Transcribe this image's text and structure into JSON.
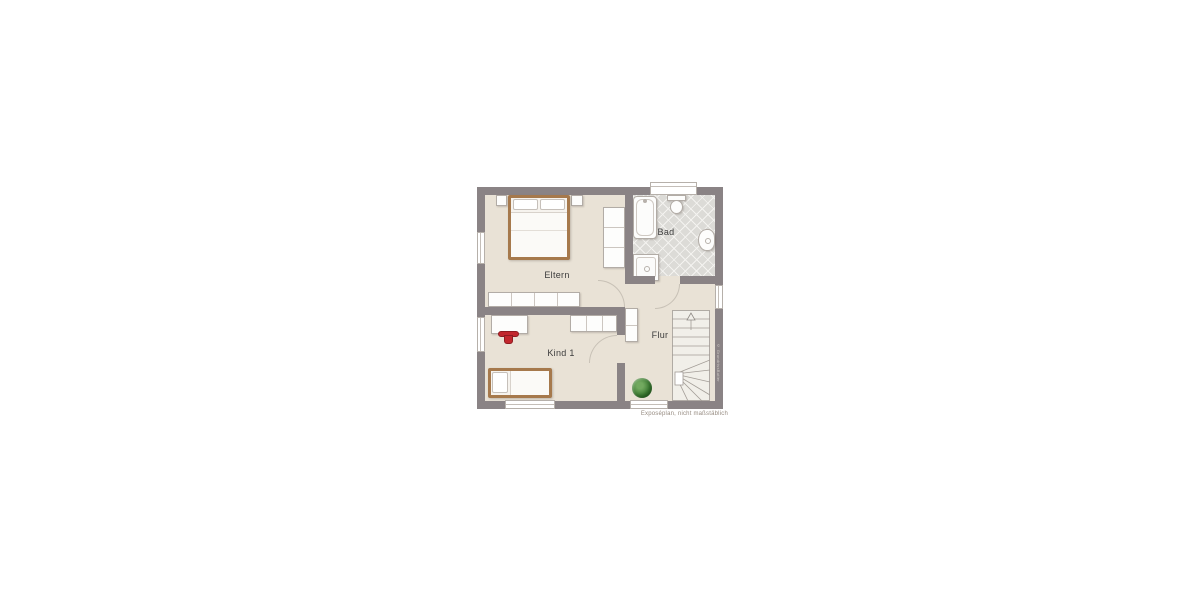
{
  "floorplan": {
    "caption": "Exposéplan, nicht maßstäblich",
    "watermark": "© GrundrissButler",
    "rooms": [
      {
        "name": "Eltern",
        "type": "parents-bedroom",
        "floor": "beige",
        "windows": 1,
        "furniture": [
          "double-bed",
          "nightstand-left",
          "nightstand-right",
          "sideboard",
          "wardrobe"
        ]
      },
      {
        "name": "Bad",
        "type": "bathroom",
        "floor": "tiled",
        "windows": 1,
        "furniture": [
          "bathtub",
          "toilet",
          "shower",
          "washbasin"
        ]
      },
      {
        "name": "Flur",
        "type": "hallway",
        "floor": "beige",
        "windows": 2,
        "furniture": [
          "cabinet",
          "plant",
          "winder-staircase"
        ]
      },
      {
        "name": "Kind 1",
        "type": "child-bedroom",
        "floor": "beige",
        "windows": 2,
        "furniture": [
          "desk",
          "red-chair",
          "single-bed",
          "wardrobe"
        ]
      }
    ],
    "colors": {
      "wall": "#8a8385",
      "floor": "#e9e2d6",
      "bath_tile": "#dcdbd7",
      "furniture": "#fdfdfc",
      "wood_frame": "#a6794c",
      "accent_red": "#c2272d",
      "plant_green": "#3f7d35",
      "label_text": "#3c3c3c",
      "caption_text": "#968b80"
    }
  }
}
